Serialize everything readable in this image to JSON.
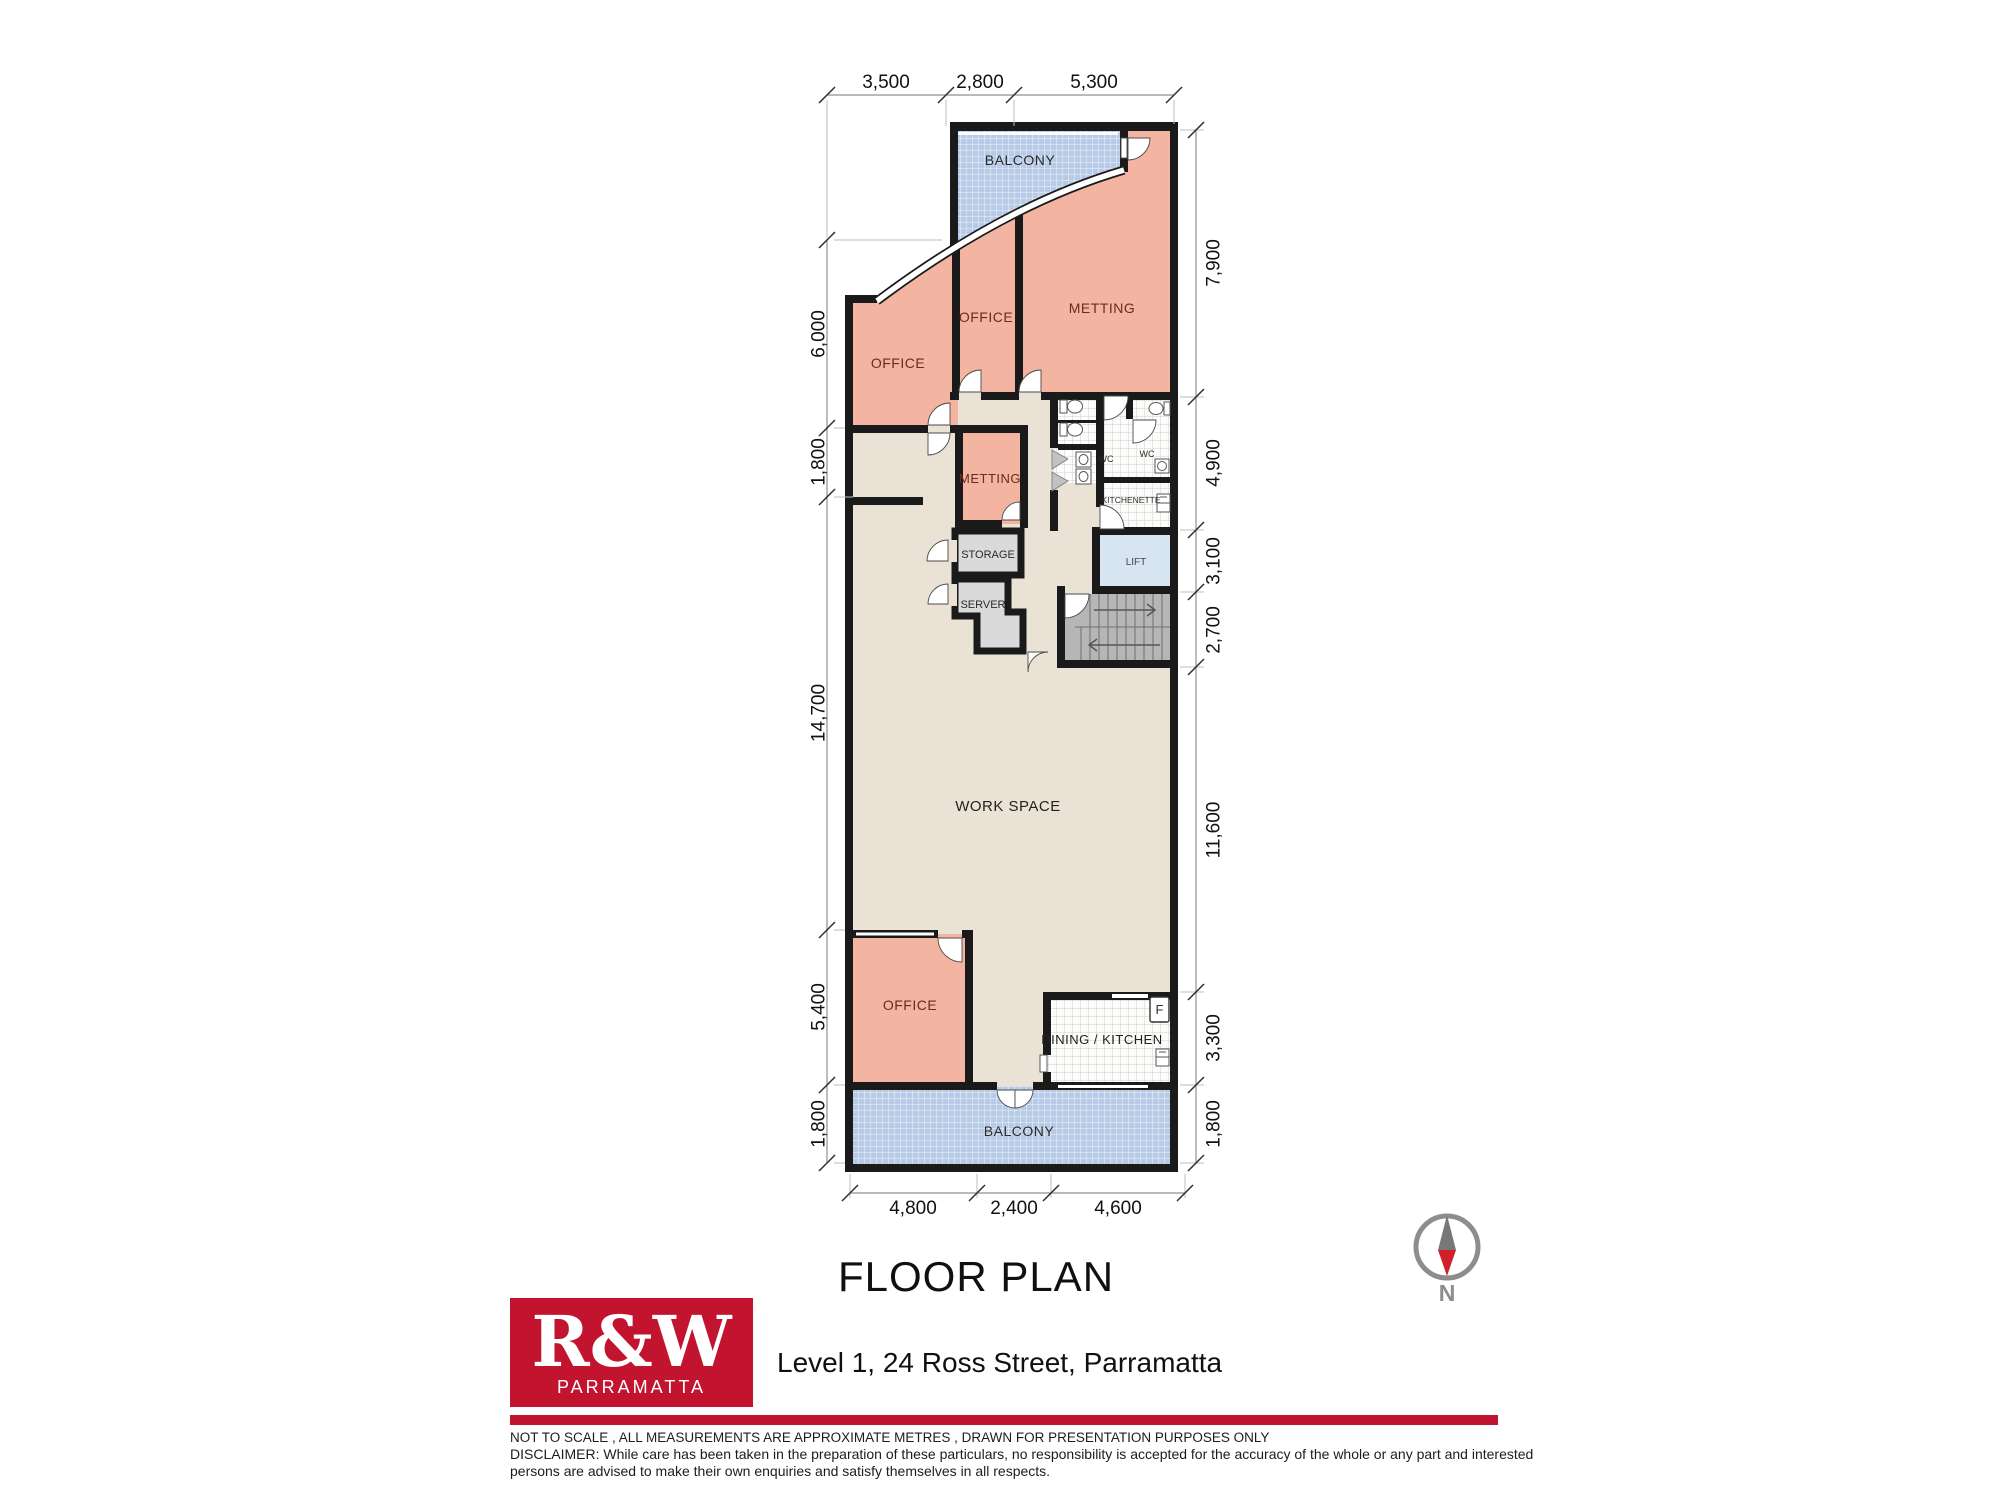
{
  "title": "FLOOR PLAN",
  "address": "Level 1, 24 Ross Street, Parramatta",
  "logo": {
    "brand": "R&W",
    "suburb": "PARRAMATTA"
  },
  "compass": {
    "north_label": "N"
  },
  "rooms": {
    "balcony_top": "BALCONY",
    "office_top_left": "OFFICE",
    "office_top_mid": "OFFICE",
    "meeting_top": "METTING",
    "meeting_small": "METTING",
    "wc_left": "WC",
    "wc_right": "WC",
    "kitchenette": "KITCHENETTE",
    "lift": "LIFT",
    "storage": "STORAGE",
    "server": "SERVER",
    "work_space": "WORK SPACE",
    "office_bottom": "OFFICE",
    "dining_kitchen": "DINING / KITCHEN",
    "balcony_bottom": "BALCONY",
    "fridge": "F"
  },
  "dimensions": {
    "top": [
      "3,500",
      "2,800",
      "5,300"
    ],
    "bottom": [
      "4,800",
      "2,400",
      "4,600"
    ],
    "left": [
      "6,000",
      "1,800",
      "14,700",
      "5,400",
      "1,800"
    ],
    "right": [
      "7,900",
      "4,900",
      "3,100",
      "2,700",
      "11,600",
      "3,300",
      "1,800"
    ]
  },
  "footer": {
    "line1": "NOT TO SCALE , ALL MEASUREMENTS ARE APPROXIMATE METRES , DRAWN FOR PRESENTATION PURPOSES ONLY",
    "line2": "DISCLAIMER:  While care has been taken in the preparation of these particulars, no responsibility is accepted for the accuracy of the whole or any part and interested",
    "line3": "persons are advised to make their own enquiries and satisfy  themselves in all respects."
  },
  "colors": {
    "brand_red": "#c3142f",
    "room_pink": "#f3b5a1",
    "floor_beige": "#eae3d5",
    "balcony_blue": "#b7cbe7",
    "lift_blue": "#d7e5f3",
    "wall_black": "#1a1a1a"
  }
}
